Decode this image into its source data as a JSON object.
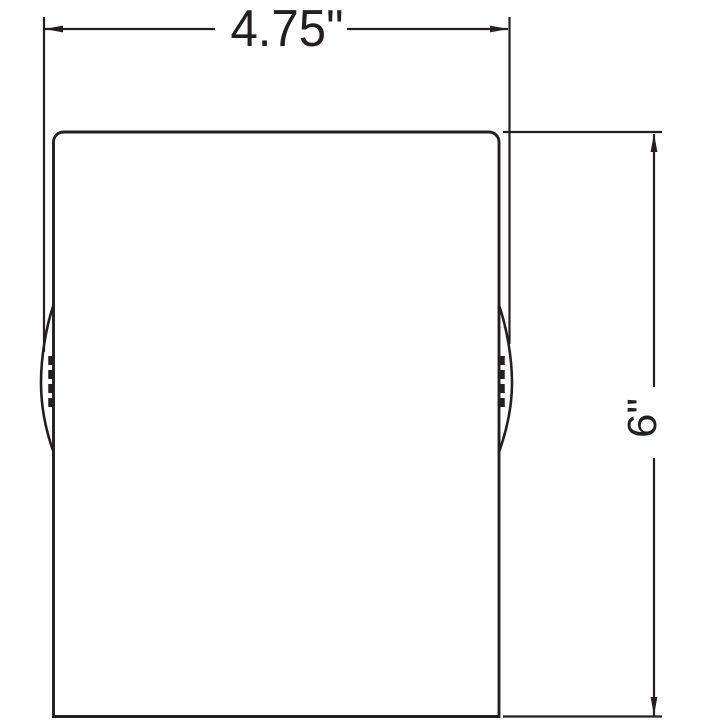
{
  "drawing": {
    "description": "technical dimension drawing of cylindrical product side view",
    "width_dimension": {
      "label": "4.75\""
    },
    "height_dimension": {
      "label": "6\""
    }
  },
  "colors": {
    "line": "#231f20",
    "background": "#ffffff"
  }
}
